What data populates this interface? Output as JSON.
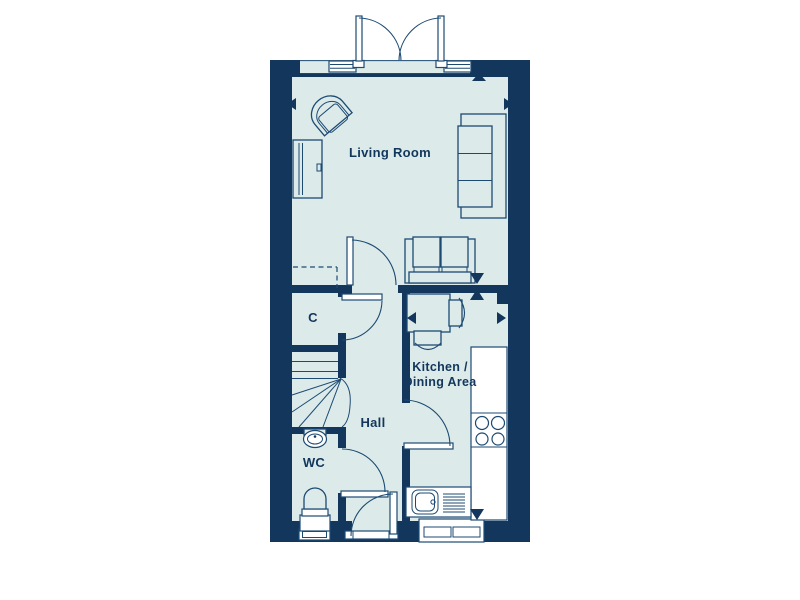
{
  "colors": {
    "page_background": "#ffffff",
    "wall": "#12365c",
    "floor": "#dcebe9",
    "line": "#1d4a73",
    "white": "#ffffff"
  },
  "labels": {
    "living_room": "Living Room",
    "cupboard": "C",
    "kitchen_line1": "Kitchen /",
    "kitchen_line2": "Dining Area",
    "hall": "Hall",
    "wc": "WC"
  },
  "plan": {
    "doors": [
      "french-doors",
      "hall-door",
      "cupboard-door",
      "kitchen-door",
      "wc-door",
      "front-door"
    ],
    "windows": [
      "top-wall-left-window",
      "top-wall-right-window",
      "wc-window",
      "kitchen-window"
    ],
    "furniture": {
      "living_room": [
        "tub-armchair",
        "tv-unit",
        "three-seat-sofa",
        "loveseat"
      ],
      "kitchen_dining": [
        "dining-table",
        "dining-chair",
        "dining-chair",
        "worktop-with-hob",
        "sink-with-drainer"
      ],
      "hall": [
        "staircase-with-winders"
      ],
      "wc": [
        "basin",
        "toilet"
      ]
    },
    "dimension_arrow_count": 8
  }
}
